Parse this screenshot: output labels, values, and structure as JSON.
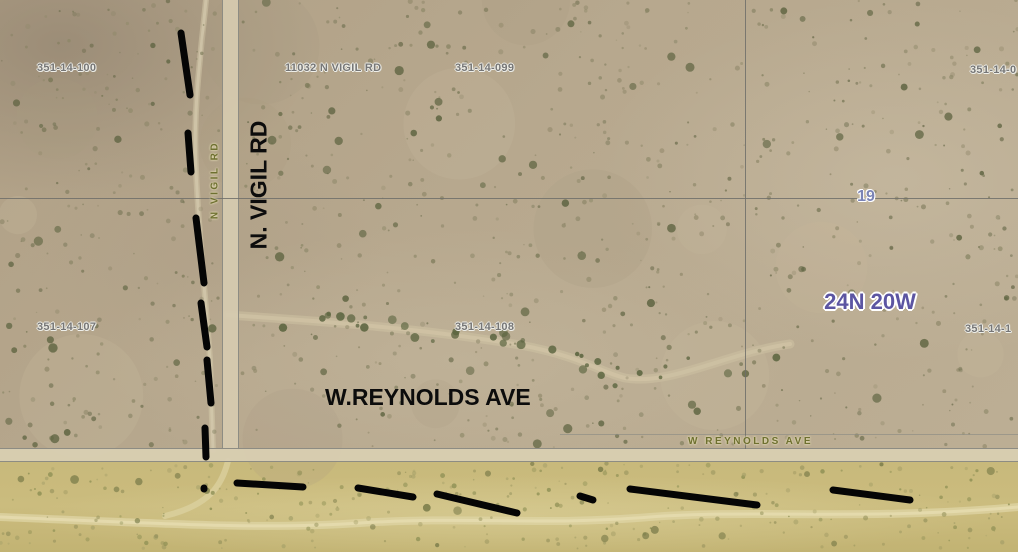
{
  "map": {
    "type": "aerial-parcel-map",
    "parcel_labels": [
      {
        "text": "351-14-100",
        "x": 37,
        "y": 62
      },
      {
        "text": "11032 N VIGIL RD",
        "x": 285,
        "y": 62
      },
      {
        "text": "351-14-099",
        "x": 455,
        "y": 62
      },
      {
        "text": "351-14-0",
        "x": 970,
        "y": 64
      },
      {
        "text": "351-14-107",
        "x": 37,
        "y": 321
      },
      {
        "text": "351-14-108",
        "x": 455,
        "y": 321
      },
      {
        "text": "351-14-1",
        "x": 965,
        "y": 323
      }
    ],
    "section_number": "19",
    "township_label": "24N 20W",
    "road_labels": {
      "vigil_large": "N. VIGIL RD",
      "reynolds_large": "W.REYNOLDS AVE",
      "vigil_small": "N VIGIL RD",
      "reynolds_small": "W  REYNOLDS  AVE"
    },
    "annotations": {
      "stroke_color": "#050505",
      "stroke_width": 7,
      "vertical_dashes": [
        [
          181,
          33,
          190,
          95
        ],
        [
          188,
          133,
          191,
          172
        ],
        [
          196,
          218,
          204,
          283
        ],
        [
          201,
          303,
          207,
          347
        ],
        [
          207,
          360,
          211,
          403
        ],
        [
          205,
          428,
          206,
          457
        ],
        [
          204,
          488,
          204,
          489
        ]
      ],
      "horizontal_dashes": [
        [
          237,
          483,
          303,
          487
        ],
        [
          358,
          488,
          413,
          497
        ],
        [
          437,
          494,
          517,
          513
        ],
        [
          580,
          496,
          593,
          500
        ],
        [
          630,
          489,
          757,
          505
        ],
        [
          833,
          490,
          910,
          500
        ]
      ]
    },
    "colors": {
      "terrain_upper": "#b7a88e",
      "terrain_lower": "#c9ba7c",
      "road_fill": "#d6cbb0",
      "road_edge": "#8d8c83",
      "parcel_line": "#6e6e6a",
      "parcel_label_text": "#767676",
      "section_number_text": "#7b84b6",
      "township_text": "#5c55a2",
      "small_road_label_text": "#6e7030",
      "annotation_black": "#050505"
    }
  }
}
